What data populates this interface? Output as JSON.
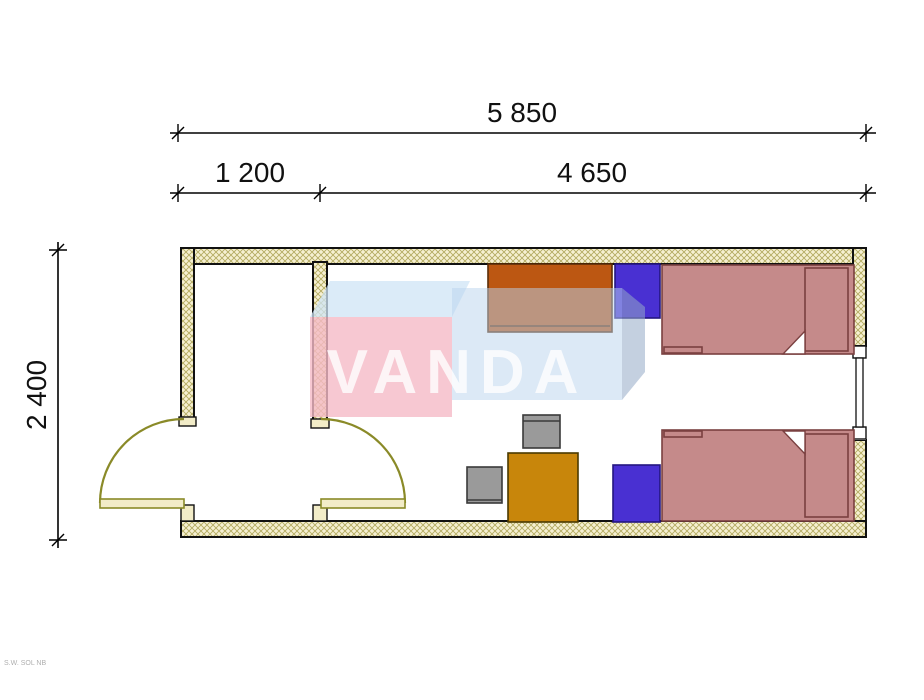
{
  "dimensions": {
    "total_width": "5 850",
    "left_section_width": "1 200",
    "right_section_width": "4 650",
    "depth": "2 400"
  },
  "watermark": {
    "text": "VANDA"
  },
  "corner_note": "S.W. SOL NB",
  "colors": {
    "wall_fill": "#f6f0d2",
    "wall_hatch": "#b3aa60",
    "cap_fill": "#f2ecc8",
    "door": "#8a8a28",
    "door_leaf": "#f2ecc8",
    "bed": "#c58a8a",
    "bed_fold": "#ffffff",
    "desk": "#bc5712",
    "nightstand": "#4930d2",
    "table": "#c8860b",
    "chair": "#9a9a9a",
    "window_glass": "#ffffff",
    "watermark_pink": "#f5bac7",
    "watermark_top": "#cfe4f5",
    "watermark_blue": "#b9d4ee",
    "watermark_side": "#93aac6",
    "watermark_text": "#ffffff"
  }
}
